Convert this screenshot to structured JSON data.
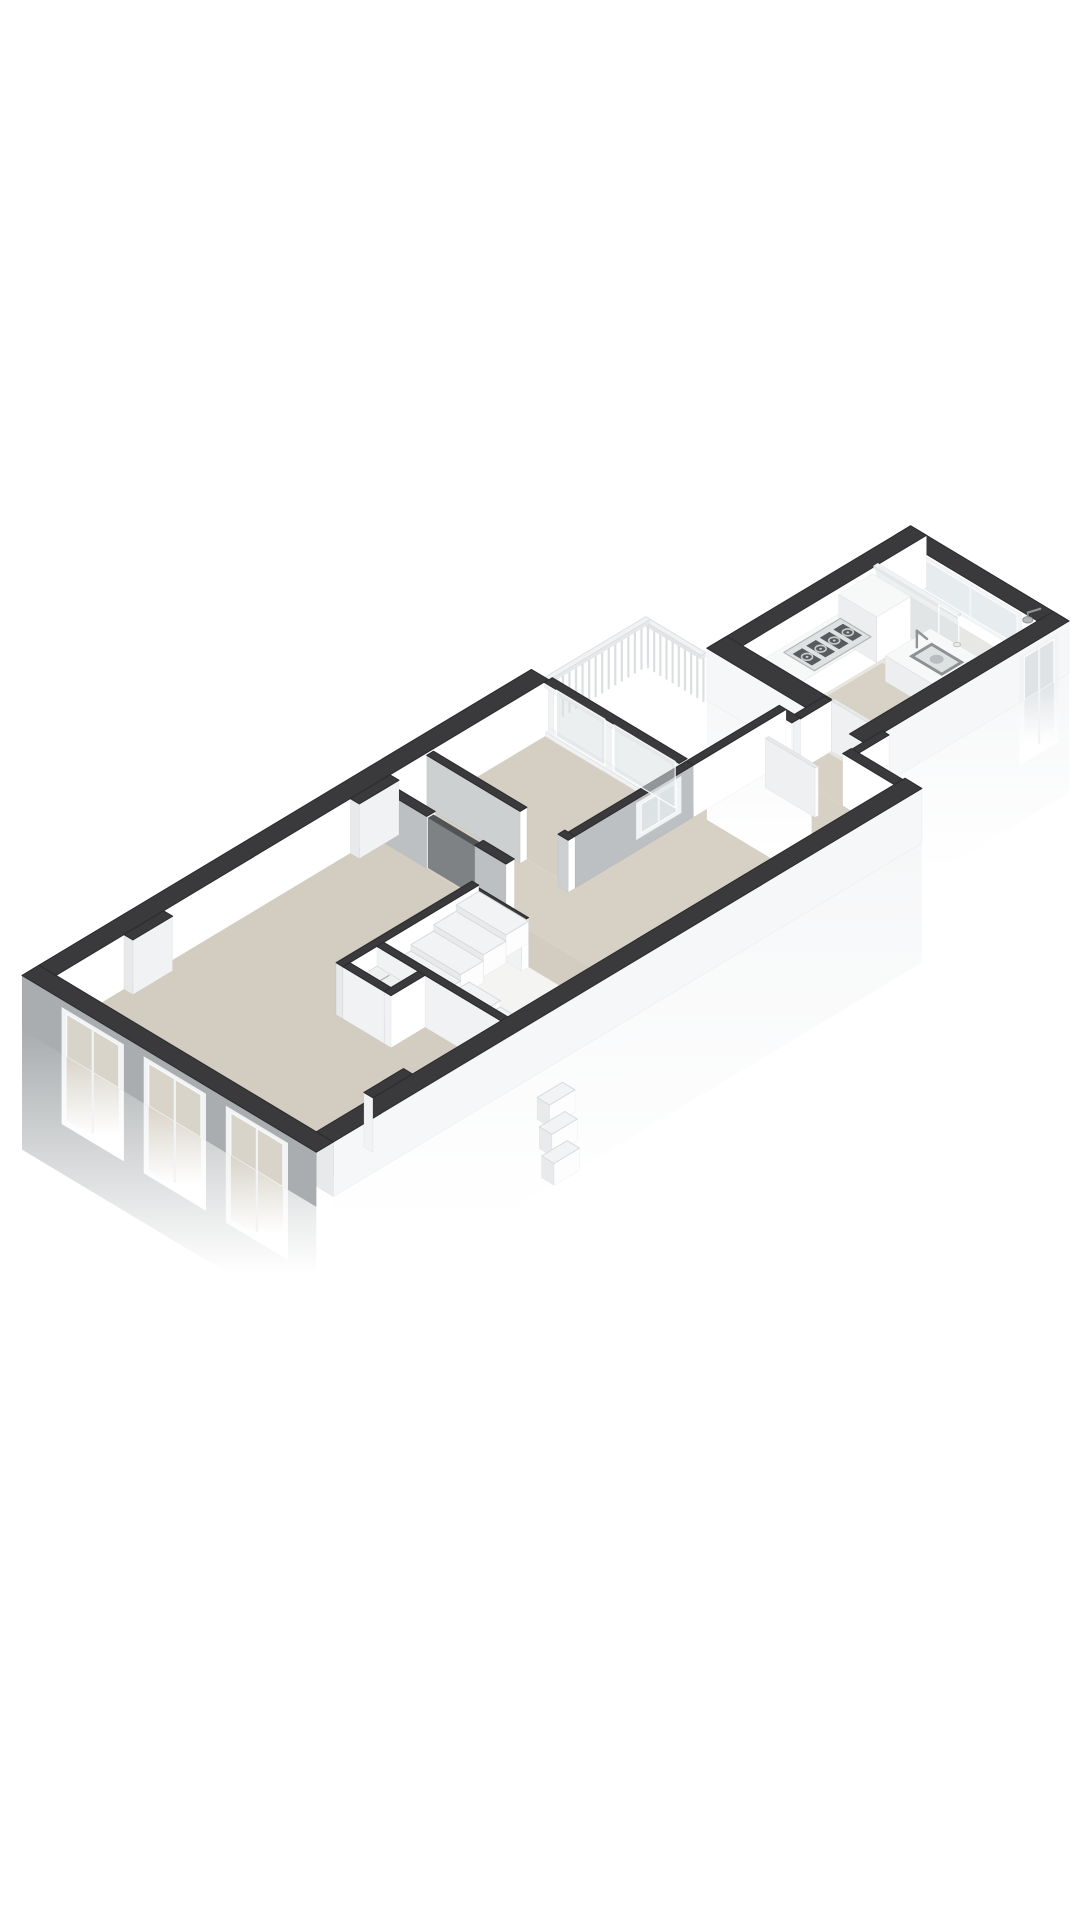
{
  "view": {
    "canvas_w": 1080,
    "canvas_h": 1920,
    "background": "#ffffff",
    "type": "3d-floorplan-axonometric"
  },
  "projection": {
    "ox": 22,
    "oy": 1030,
    "du": 56.6,
    "dv": 34,
    "dh": 52,
    "fade": 2.3
  },
  "colors": {
    "top": "#3a3a3c",
    "topStroke": "#2b2b2d",
    "extWhite": "#f6f7f8",
    "gableGray": "#a9adaf",
    "intWhite": "#ffffff",
    "intWhiteDim": "#f1f2f3",
    "intWhiteDark": "#e7e9ea",
    "grayFace": "#bcc0c2",
    "grayFaceLight": "#cdd0d1",
    "doorGray": "#909496",
    "doorGrayDark": "#515456",
    "doorGraySide": "#7e8284",
    "doorWhiteTop": "#e6e8e9",
    "doorWhiteFace": "#fcfdfd",
    "doorWhiteSide": "#eef0f1",
    "floorLiving": "#d3ccc0",
    "floorHall": "#d7d1c5",
    "floorBed": "#d5cec2",
    "floorKitchen": "#e9e6e0",
    "floorKitchenBeige": "#d8d2c6",
    "floorShower": "#e7e7e5",
    "floorCloset": "#c0c3c4",
    "floorStairVoid": "#f4f4f3",
    "counter": "#f7f8f8",
    "counterSide": "#ffffff",
    "counterShadow": "#eceeef",
    "frame": "#f2f3f4",
    "glass": "#dde2e4",
    "glassBeige": "#d9d4ca",
    "glassCool": "#dfe3e6",
    "glassBright": "#e7ecee",
    "railStroke": "#dcdfe0",
    "railTop": "#f1f2f3",
    "railSide": "#e6e8e9",
    "railShadow": "#e2e4e5",
    "stepTop": "#f2f3f4",
    "stepFace": "#fdfdfe",
    "stepShadow": "#e8eaeb",
    "stepEdge": "#d7dadc",
    "shelf": "#eff1f1",
    "slat": "#aeb1b2",
    "hobBase": "#dfe2e3",
    "hobEdge": "#b5b8ba",
    "grate": "#585c5e",
    "burner": "#c9cccd",
    "sinkOuter": "#8d9193",
    "sinkInner": "#dfe2e3",
    "basin": "#b9bdbf",
    "fixture": "#8f9395",
    "showerHead": "#b4b8ba",
    "drainFill": "#e8eaec",
    "drainEdge": "#c0c3c5"
  },
  "scene": [
    {
      "t": "floor",
      "n": "living-room-floor",
      "u": [
        0.3,
        5.95
      ],
      "v": [
        0.3,
        4.9
      ],
      "c": "floorLiving"
    },
    {
      "t": "floor",
      "n": "stair-void-floor",
      "u": [
        3.72,
        5.4
      ],
      "v": [
        2.67,
        4.9
      ],
      "c": "floorStairVoid"
    },
    {
      "t": "floor",
      "n": "closet-floor",
      "u": [
        3.12,
        3.6
      ],
      "v": [
        2.67,
        3.4
      ],
      "c": "floorCloset"
    },
    {
      "t": "floor",
      "n": "hall-floor-west",
      "u": [
        5.95,
        6.97
      ],
      "v": [
        0.3,
        2.8
      ],
      "c": "floorHall"
    },
    {
      "t": "floor",
      "n": "hall-floor-main",
      "u": [
        5.95,
        10.55
      ],
      "v": [
        2.6,
        4.9
      ],
      "c": "floorHall"
    },
    {
      "t": "floor",
      "n": "bedroom-floor",
      "u": [
        6.97,
        8.94
      ],
      "v": [
        0.3,
        2.68
      ],
      "c": "floorBed"
    },
    {
      "t": "floor",
      "n": "link-corridor-floor",
      "u": [
        10.55,
        11.25
      ],
      "v": [
        3.05,
        3.95
      ],
      "c": "floorHall"
    },
    {
      "t": "floor",
      "n": "kitchen-floor",
      "u": [
        11.2,
        14.22
      ],
      "v": [
        1.48,
        3.72
      ],
      "c": "floorKitchen"
    },
    {
      "t": "floor",
      "n": "kitchen-walkway-floor",
      "u": [
        11.25,
        13.0
      ],
      "v": [
        2.2,
        3.72
      ],
      "c": "floorKitchenBeige"
    },
    {
      "t": "floor",
      "n": "shower-room-floor",
      "u": [
        13.62,
        14.22
      ],
      "v": [
        1.48,
        3.72
      ],
      "c": "floorShower"
    },
    {
      "t": "box",
      "n": "wall-nw-long",
      "u": [
        0.3,
        9.0
      ],
      "v": [
        0,
        0.3
      ],
      "h1": 1.05,
      "c": [
        "top",
        "intWhite",
        null
      ],
      "d": -6.5
    },
    {
      "t": "box",
      "n": "wall-niche-nw-1",
      "u": [
        1.5,
        2.2
      ],
      "v": [
        0.3,
        0.46
      ],
      "h1": 1.05,
      "c": [
        "top",
        "intWhiteDim",
        "intWhiteDark"
      ],
      "d": 0.1
    },
    {
      "t": "box",
      "n": "wall-niche-nw-2",
      "u": [
        5.5,
        6.2
      ],
      "v": [
        0.3,
        0.46
      ],
      "h1": 1.05,
      "c": [
        "top",
        "intWhiteDim",
        "intWhiteDark"
      ],
      "d": 0.12
    },
    {
      "t": "box",
      "n": "wall-gable-sw",
      "u": [
        0,
        0.3
      ],
      "v": [
        0,
        5.2
      ],
      "h1": 1.05,
      "c": [
        "top",
        null,
        "gableGray"
      ],
      "f": [
        "sw"
      ],
      "d": 5.2,
      "p": [
        {
          "face": "sw",
          "a": [
            0.7,
            1.8
          ],
          "b": [
            -1.35,
            0.9
          ],
          "frame": "frame",
          "glass": "glassBeige",
          "mull": true
        },
        {
          "face": "sw",
          "a": [
            2.15,
            3.25
          ],
          "b": [
            -1.35,
            0.9
          ],
          "frame": "frame",
          "glass": "glassBeige",
          "mull": true
        },
        {
          "face": "sw",
          "a": [
            3.6,
            4.7
          ],
          "b": [
            -1.35,
            0.9
          ],
          "frame": "frame",
          "glass": "glassBeige",
          "mull": true
        }
      ]
    },
    {
      "t": "box",
      "n": "wall-se-long",
      "u": [
        0.3,
        10.7
      ],
      "v": [
        4.9,
        5.2
      ],
      "h1": 1.05,
      "c": [
        "top",
        "extWhite",
        "intWhiteDark"
      ],
      "f": [
        "se"
      ],
      "d": 4.9
    },
    {
      "t": "box",
      "n": "wall-niche-se",
      "u": [
        1.3,
        2.0
      ],
      "v": [
        4.74,
        4.9
      ],
      "h1": 1.05,
      "c": [
        "top",
        null,
        "intWhiteDim"
      ],
      "d": 4.95
    },
    {
      "t": "box",
      "n": "stair-wall-nw",
      "u": [
        3.0,
        5.4
      ],
      "v": [
        2.55,
        2.67
      ],
      "h1": 1.0,
      "c": [
        "top",
        "intWhite",
        "intWhiteDark"
      ],
      "d": -0.33
    },
    {
      "t": "box",
      "n": "stair-wall-sw",
      "u": [
        3.6,
        3.72
      ],
      "v": [
        2.67,
        4.9
      ],
      "h1": 1.0,
      "c": [
        "top",
        null,
        "intWhiteDim"
      ],
      "d": 1.3
    },
    {
      "t": "box",
      "n": "stair-half-wall",
      "u": [
        5.28,
        5.4
      ],
      "v": [
        2.67,
        3.55
      ],
      "h1": 0.95,
      "c": [
        "top",
        "intWhite",
        "intWhiteDim"
      ],
      "d": -1.73
    },
    {
      "t": "box",
      "n": "closet-wall-sw",
      "u": [
        3.0,
        3.12
      ],
      "v": [
        2.67,
        3.4
      ],
      "h1": 1.0,
      "c": [
        "top",
        null,
        "intWhiteDim"
      ],
      "d": 1.48
    },
    {
      "t": "box",
      "n": "closet-wall-se",
      "u": [
        3.0,
        3.6
      ],
      "v": [
        3.4,
        3.52
      ],
      "h1": 1.0,
      "c": [
        "top",
        "intWhite",
        "intWhiteDim"
      ],
      "d": 1.5
    },
    {
      "t": "shelf",
      "n": "closet-shelf-low",
      "u": [
        3.12,
        3.6
      ],
      "v": [
        2.67,
        3.4
      ],
      "h": 0.34,
      "d": 1.4
    },
    {
      "t": "shelf",
      "n": "closet-shelf-high",
      "u": [
        3.12,
        3.6
      ],
      "v": [
        2.67,
        3.4
      ],
      "h": 0.62,
      "d": 1.45
    },
    {
      "t": "box",
      "n": "divider-wall-a",
      "u": [
        5.95,
        6.1
      ],
      "v": [
        0.3,
        1.2
      ],
      "h1": 1.0,
      "c": [
        "top",
        "intWhite",
        "grayFace"
      ],
      "d": -4.75
    },
    {
      "t": "box",
      "n": "divider-wall-b",
      "u": [
        5.95,
        6.1
      ],
      "v": [
        2.05,
        2.6
      ],
      "h1": 1.0,
      "c": [
        "top",
        "intWhite",
        "grayFace"
      ],
      "d": -3.35
    },
    {
      "t": "box",
      "n": "living-door-panel",
      "u": [
        5.97,
        6.07
      ],
      "v": [
        1.2,
        2.05
      ],
      "h1": 0.96,
      "c": [
        "doorGrayDark",
        "doorGray",
        "doorGraySide"
      ],
      "d": -3.92
    },
    {
      "t": "box",
      "n": "bedroom-wall-sw-a",
      "u": [
        6.85,
        6.97
      ],
      "v": [
        0.3,
        1.95
      ],
      "h1": 1.0,
      "c": [
        "top",
        "intWhite",
        "grayFaceLight"
      ],
      "d": -4.9
    },
    {
      "t": "box",
      "n": "bedroom-wall-sw-b",
      "u": [
        6.85,
        6.97
      ],
      "v": [
        2.62,
        2.8
      ],
      "h1": 1.0,
      "c": [
        "top",
        "intWhite",
        "grayFaceLight"
      ],
      "d": -4.2
    },
    {
      "t": "box",
      "n": "bedroom-wall-se",
      "u": [
        6.97,
        9.06
      ],
      "v": [
        2.68,
        2.8
      ],
      "h1": 1.0,
      "c": [
        "top",
        "grayFace",
        null
      ],
      "d": -4.17,
      "p": [
        {
          "face": "se",
          "a": [
            8.05,
            8.85
          ],
          "b": [
            0.22,
            0.93
          ],
          "frame": "frame",
          "glass": "glass",
          "mull": true
        }
      ]
    },
    {
      "t": "box",
      "n": "bedroom-glazing-sill",
      "u": [
        8.95,
        9.05
      ],
      "v": [
        0.3,
        2.68
      ],
      "h1": 0.07,
      "c": [
        "intWhiteDim",
        "intWhite",
        "intWhiteDim"
      ]
    },
    {
      "t": "box",
      "n": "bedroom-glazing-mullion-1",
      "u": [
        8.95,
        9.05
      ],
      "v": [
        0.3,
        0.44
      ],
      "h1": 0.94,
      "c": [
        "intWhiteDim",
        "intWhite",
        "intWhiteDim"
      ]
    },
    {
      "t": "box",
      "n": "bedroom-glazing-mullion-2",
      "u": [
        8.95,
        9.05
      ],
      "v": [
        1.3,
        1.46
      ],
      "h1": 0.94,
      "c": [
        "intWhiteDim",
        "intWhite",
        "intWhiteDim"
      ]
    },
    {
      "t": "box",
      "n": "bedroom-glazing-mullion-3",
      "u": [
        8.95,
        9.05
      ],
      "v": [
        2.54,
        2.68
      ],
      "h1": 0.94,
      "c": [
        "intWhiteDim",
        "intWhite",
        "intWhiteDim"
      ]
    },
    {
      "t": "glass",
      "n": "bedroom-glass-door-pane",
      "plane": "u",
      "at": 9.0,
      "a": [
        0.44,
        1.3
      ],
      "h": [
        0.05,
        0.94
      ],
      "c": "glass"
    },
    {
      "t": "glass",
      "n": "bedroom-glass-window-pane",
      "plane": "u",
      "at": 9.0,
      "a": [
        1.46,
        2.54
      ],
      "h": [
        0.05,
        0.94
      ],
      "c": "glass"
    },
    {
      "t": "box",
      "n": "bedroom-glazing-header",
      "u": [
        8.93,
        9.07
      ],
      "v": [
        0.3,
        2.68
      ],
      "h0": 0.94,
      "h1": 1.04,
      "c": [
        "top",
        "intWhiteDim",
        "intWhiteDim"
      ]
    },
    {
      "t": "box",
      "n": "vestibule-wall-nw",
      "u": [
        9.06,
        10.7
      ],
      "v": [
        2.68,
        2.8
      ],
      "h1": 1.0,
      "c": [
        "top",
        "intWhite",
        null
      ],
      "d": -6.26
    },
    {
      "t": "box",
      "n": "vestibule-wall-ne-a",
      "u": [
        10.55,
        10.7
      ],
      "v": [
        2.8,
        3.05
      ],
      "h1": 1.0,
      "c": [
        "top",
        null,
        "intWhite"
      ],
      "d": -7.5
    },
    {
      "t": "box",
      "n": "vestibule-wall-ne-b",
      "u": [
        10.55,
        10.7
      ],
      "v": [
        3.95,
        4.9
      ],
      "h1": 1.0,
      "c": [
        "top",
        null,
        "intWhite"
      ],
      "d": -5.65
    },
    {
      "t": "box",
      "n": "vestibule-open-door",
      "u": [
        10.13,
        10.19
      ],
      "v": [
        3.0,
        3.88
      ],
      "h1": 0.95,
      "c": [
        "doorWhiteTop",
        "doorWhiteFace",
        "doorWhiteSide"
      ]
    },
    {
      "t": "box",
      "n": "corridor-wall-nw",
      "u": [
        10.7,
        11.25
      ],
      "v": [
        2.93,
        3.05
      ],
      "h1": 0.98,
      "c": [
        "top",
        "intWhite",
        "intWhiteDim"
      ],
      "d": -7.65
    },
    {
      "t": "box",
      "n": "corridor-wall-se",
      "u": [
        10.7,
        11.25
      ],
      "v": [
        3.95,
        4.07
      ],
      "h1": 0.98,
      "c": [
        "top",
        "intWhite",
        "intWhiteDim"
      ],
      "d": -6.63
    },
    {
      "t": "box",
      "n": "kitchen-open-door",
      "u": [
        11.25,
        11.31
      ],
      "v": [
        3.05,
        3.9
      ],
      "h1": 0.97,
      "c": [
        "doorWhiteTop",
        "doorWhiteFace",
        "doorWhiteSide"
      ],
      "d": -7.35
    },
    {
      "t": "rail",
      "n": "terrace-railing-nw",
      "u": [
        9.05,
        10.9
      ],
      "v": [
        0.12,
        0.2
      ],
      "axis": "u",
      "h": 0.82,
      "d": -8.85
    },
    {
      "t": "rail",
      "n": "terrace-railing-ne",
      "u": [
        10.82,
        10.9
      ],
      "v": [
        0.2,
        1.18
      ],
      "axis": "v",
      "h": 0.82,
      "d": -9.6
    },
    {
      "t": "box",
      "n": "kitchen-wall-ne-end",
      "u": [
        14.22,
        14.5
      ],
      "v": [
        1.2,
        4.0
      ],
      "h1": 1.0,
      "c": [
        "top",
        null,
        "intWhite"
      ],
      "d": -10.3,
      "p": [
        {
          "face": "sw",
          "a": [
            1.62,
            3.45
          ],
          "b": [
            0.22,
            0.96
          ],
          "frame": "frame",
          "glass": "glassBright",
          "mull": true
        }
      ]
    },
    {
      "t": "box",
      "n": "kitchen-wall-nw",
      "u": [
        10.9,
        14.5
      ],
      "v": [
        1.2,
        1.48
      ],
      "h1": 1.0,
      "c": [
        "top",
        "intWhite",
        null
      ],
      "d": -9.42
    },
    {
      "t": "glass",
      "n": "shower-glass-panel-a",
      "plane": "u",
      "at": 13.6,
      "a": [
        1.48,
        2.6
      ],
      "h": [
        0,
        0.98
      ],
      "c": "glassCool",
      "d": -9.3
    },
    {
      "t": "glass",
      "n": "shower-glass-panel-b",
      "plane": "u",
      "at": 13.6,
      "a": [
        2.6,
        2.95
      ],
      "h": [
        0,
        0.98
      ],
      "c": "glassCool",
      "d": -9.25
    },
    {
      "t": "box",
      "n": "shower-glass-header",
      "u": [
        13.56,
        13.64
      ],
      "v": [
        1.48,
        2.95
      ],
      "h0": 0.98,
      "h1": 1.03,
      "c": [
        "intWhiteDim",
        "intWhiteDark",
        "intWhiteDark"
      ],
      "d": -9.28
    },
    {
      "t": "box",
      "n": "kitchen-counter-nw",
      "u": [
        11.25,
        13.55
      ],
      "v": [
        1.48,
        2.15
      ],
      "h1": 0.5,
      "c": [
        "counter",
        "counterSide",
        "counterShadow"
      ],
      "d": -9.05
    },
    {
      "t": "box",
      "n": "kitchen-tall-unit",
      "u": [
        12.95,
        13.55
      ],
      "v": [
        1.48,
        2.15
      ],
      "h1": 0.88,
      "c": [
        "counter",
        "counterSide",
        "counterShadow"
      ],
      "d": -9.04
    },
    {
      "t": "box",
      "n": "kitchen-counter-sink",
      "u": [
        12.75,
        13.55
      ],
      "v": [
        2.5,
        3.72
      ],
      "h1": 0.5,
      "c": [
        "counter",
        "counterSide",
        "counterShadow"
      ],
      "d": -9.03
    },
    {
      "t": "hob",
      "n": "gas-hob",
      "u": [
        11.9,
        12.9
      ],
      "v": [
        1.56,
        2.1
      ],
      "d": -8.99
    },
    {
      "t": "sink",
      "n": "kitchen-sink",
      "u": [
        12.95,
        13.35
      ],
      "v": [
        2.72,
        3.3
      ],
      "d": -8.9
    },
    {
      "t": "shower",
      "n": "shower-fixture",
      "head": [
        14.32,
        3.45
      ],
      "drain": [
        13.92,
        2.6
      ],
      "d": -8.5
    },
    {
      "t": "box",
      "n": "kitchen-wall-sw-a",
      "u": [
        10.9,
        11.25
      ],
      "v": [
        1.2,
        3.05
      ],
      "h1": 1.0,
      "c": [
        "top",
        null,
        "extWhite"
      ],
      "f": [
        "sw"
      ],
      "d": -7.85
    },
    {
      "t": "box",
      "n": "kitchen-wall-sw-b",
      "u": [
        10.9,
        11.25
      ],
      "v": [
        3.95,
        4.0
      ],
      "h1": 1.0,
      "c": [
        "top",
        null,
        "extWhite"
      ],
      "d": -6.9
    },
    {
      "t": "box",
      "n": "kitchen-wall-se",
      "u": [
        10.9,
        14.5
      ],
      "v": [
        3.72,
        4.0
      ],
      "h1": 1.0,
      "c": [
        "top",
        "extWhite",
        null
      ],
      "f": [
        "se"
      ],
      "d": -6.88,
      "p": [
        {
          "face": "se",
          "a": [
            13.62,
            14.32
          ],
          "b": [
            -1.2,
            0.9
          ],
          "frame": "frame",
          "glass": "glassCool",
          "mull": true
        }
      ]
    },
    {
      "t": "tread",
      "n": "stair-tread",
      "u": [
        5.0,
        5.4
      ],
      "v": [
        2.67,
        3.55
      ],
      "h": 0.88,
      "d": 0.5
    },
    {
      "t": "tread",
      "n": "stair-tread",
      "u": [
        4.6,
        5.0
      ],
      "v": [
        2.67,
        3.55
      ],
      "h": 0.76,
      "d": 0.6
    },
    {
      "t": "tread",
      "n": "stair-tread",
      "u": [
        4.2,
        4.6
      ],
      "v": [
        2.67,
        3.55
      ],
      "h": 0.64,
      "d": 0.7
    },
    {
      "t": "tread",
      "n": "stair-tread",
      "u": [
        3.72,
        4.2
      ],
      "v": [
        2.67,
        3.55
      ],
      "h": 0.52,
      "d": 0.8
    },
    {
      "t": "tread",
      "n": "stair-winder",
      "u": [
        3.72,
        4.35
      ],
      "v": [
        3.55,
        4.1
      ],
      "h": 0.4,
      "d": 0.9
    },
    {
      "t": "tread",
      "n": "stair-winder",
      "u": [
        3.72,
        4.35
      ],
      "v": [
        4.1,
        4.5
      ],
      "h": 0.28,
      "d": 1.0
    },
    {
      "t": "tread",
      "n": "stair-winder",
      "u": [
        3.72,
        4.35
      ],
      "v": [
        4.5,
        4.9
      ],
      "h": 0.16,
      "d": 1.1
    },
    {
      "t": "tread",
      "n": "stair-step-below-facade",
      "u": [
        3.9,
        4.35
      ],
      "v": [
        5.2,
        5.42
      ],
      "h": -0.45,
      "d": 6.0
    },
    {
      "t": "tread",
      "n": "stair-step-below-facade",
      "u": [
        3.72,
        4.17
      ],
      "v": [
        5.42,
        5.64
      ],
      "h": -0.75,
      "d": 6.05
    },
    {
      "t": "tread",
      "n": "stair-step-below-facade",
      "u": [
        3.54,
        3.99
      ],
      "v": [
        5.64,
        5.86
      ],
      "h": -1.05,
      "d": 6.1
    }
  ]
}
